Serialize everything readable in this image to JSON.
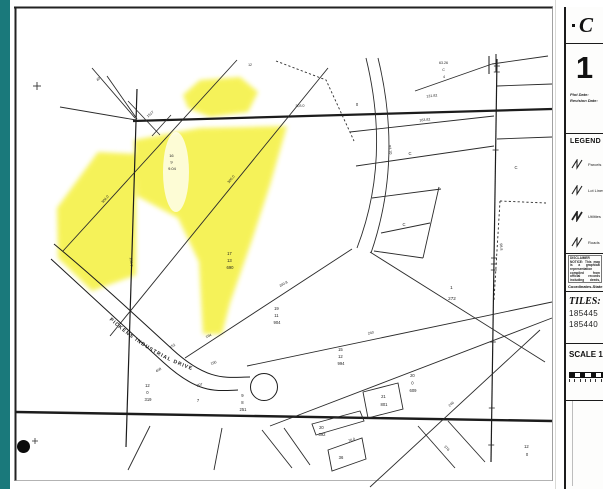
{
  "sidebar": {
    "county_initial": "C",
    "sheet_number": "1",
    "plot_date_label": "Plot Date:",
    "revision_date_label": "Revision Date:",
    "legend": {
      "title": "LEGEND",
      "items": [
        {
          "label": "Parcels"
        },
        {
          "label": "Lot Lines"
        },
        {
          "label": "Utilities"
        },
        {
          "label": "Roads"
        }
      ]
    },
    "disclaimer": "DISCLAIMER NOTICE: This map is a graphical representation compiled from official records including deeds, plats and surveys, and is provided for reference purposes only. No warranty is made as to the accuracy of the information shown and the county assumes no legal responsibility for this map or its contents.",
    "coordinates_line1": "Coordinates-State Plane",
    "coordinates_line2": "West Zone-NAD83",
    "tiles": {
      "title": "TILES:",
      "values": [
        "185445",
        "185440"
      ]
    },
    "scale": {
      "title": "SCALE 1"
    }
  },
  "map": {
    "road_label": "PICKENS INDUSTRIAL DRIVE",
    "parcels": [
      {
        "lines": [
          "16",
          "9",
          "9.04"
        ]
      },
      {
        "lines": [
          "17",
          "13",
          "690"
        ]
      },
      {
        "lines": [
          "19",
          "11",
          "904"
        ]
      },
      {
        "lines": [
          "15",
          "12",
          "994"
        ]
      },
      {
        "lines": [
          "20",
          "0",
          "609"
        ]
      },
      {
        "lines": [
          "21",
          "801"
        ]
      },
      {
        "lines": [
          "20",
          "392"
        ]
      },
      {
        "lines": [
          "36"
        ]
      },
      {
        "lines": [
          "12",
          "0",
          "319"
        ]
      },
      {
        "lines": [
          "7"
        ]
      },
      {
        "lines": [
          "9",
          "8",
          "251"
        ]
      },
      {
        "lines": [
          "1",
          "272"
        ]
      },
      {
        "lines": [
          "12",
          "0"
        ]
      },
      {
        "lines": [
          "63.26",
          "C",
          "4"
        ]
      },
      {
        "lines": [
          "C"
        ]
      },
      {
        "lines": [
          "C"
        ]
      },
      {
        "lines": [
          "0"
        ]
      },
      {
        "lines": [
          "C"
        ]
      },
      {
        "lines": [
          "12"
        ]
      }
    ],
    "dims": [
      "304.0",
      "300.0",
      "200.8",
      "240",
      "207",
      "152",
      "190",
      "408",
      "164",
      "106.7",
      "131.82",
      "163.82",
      "303.0",
      "1517",
      "40",
      "93.10",
      "246",
      "376",
      "76.0",
      "98.8"
    ]
  }
}
